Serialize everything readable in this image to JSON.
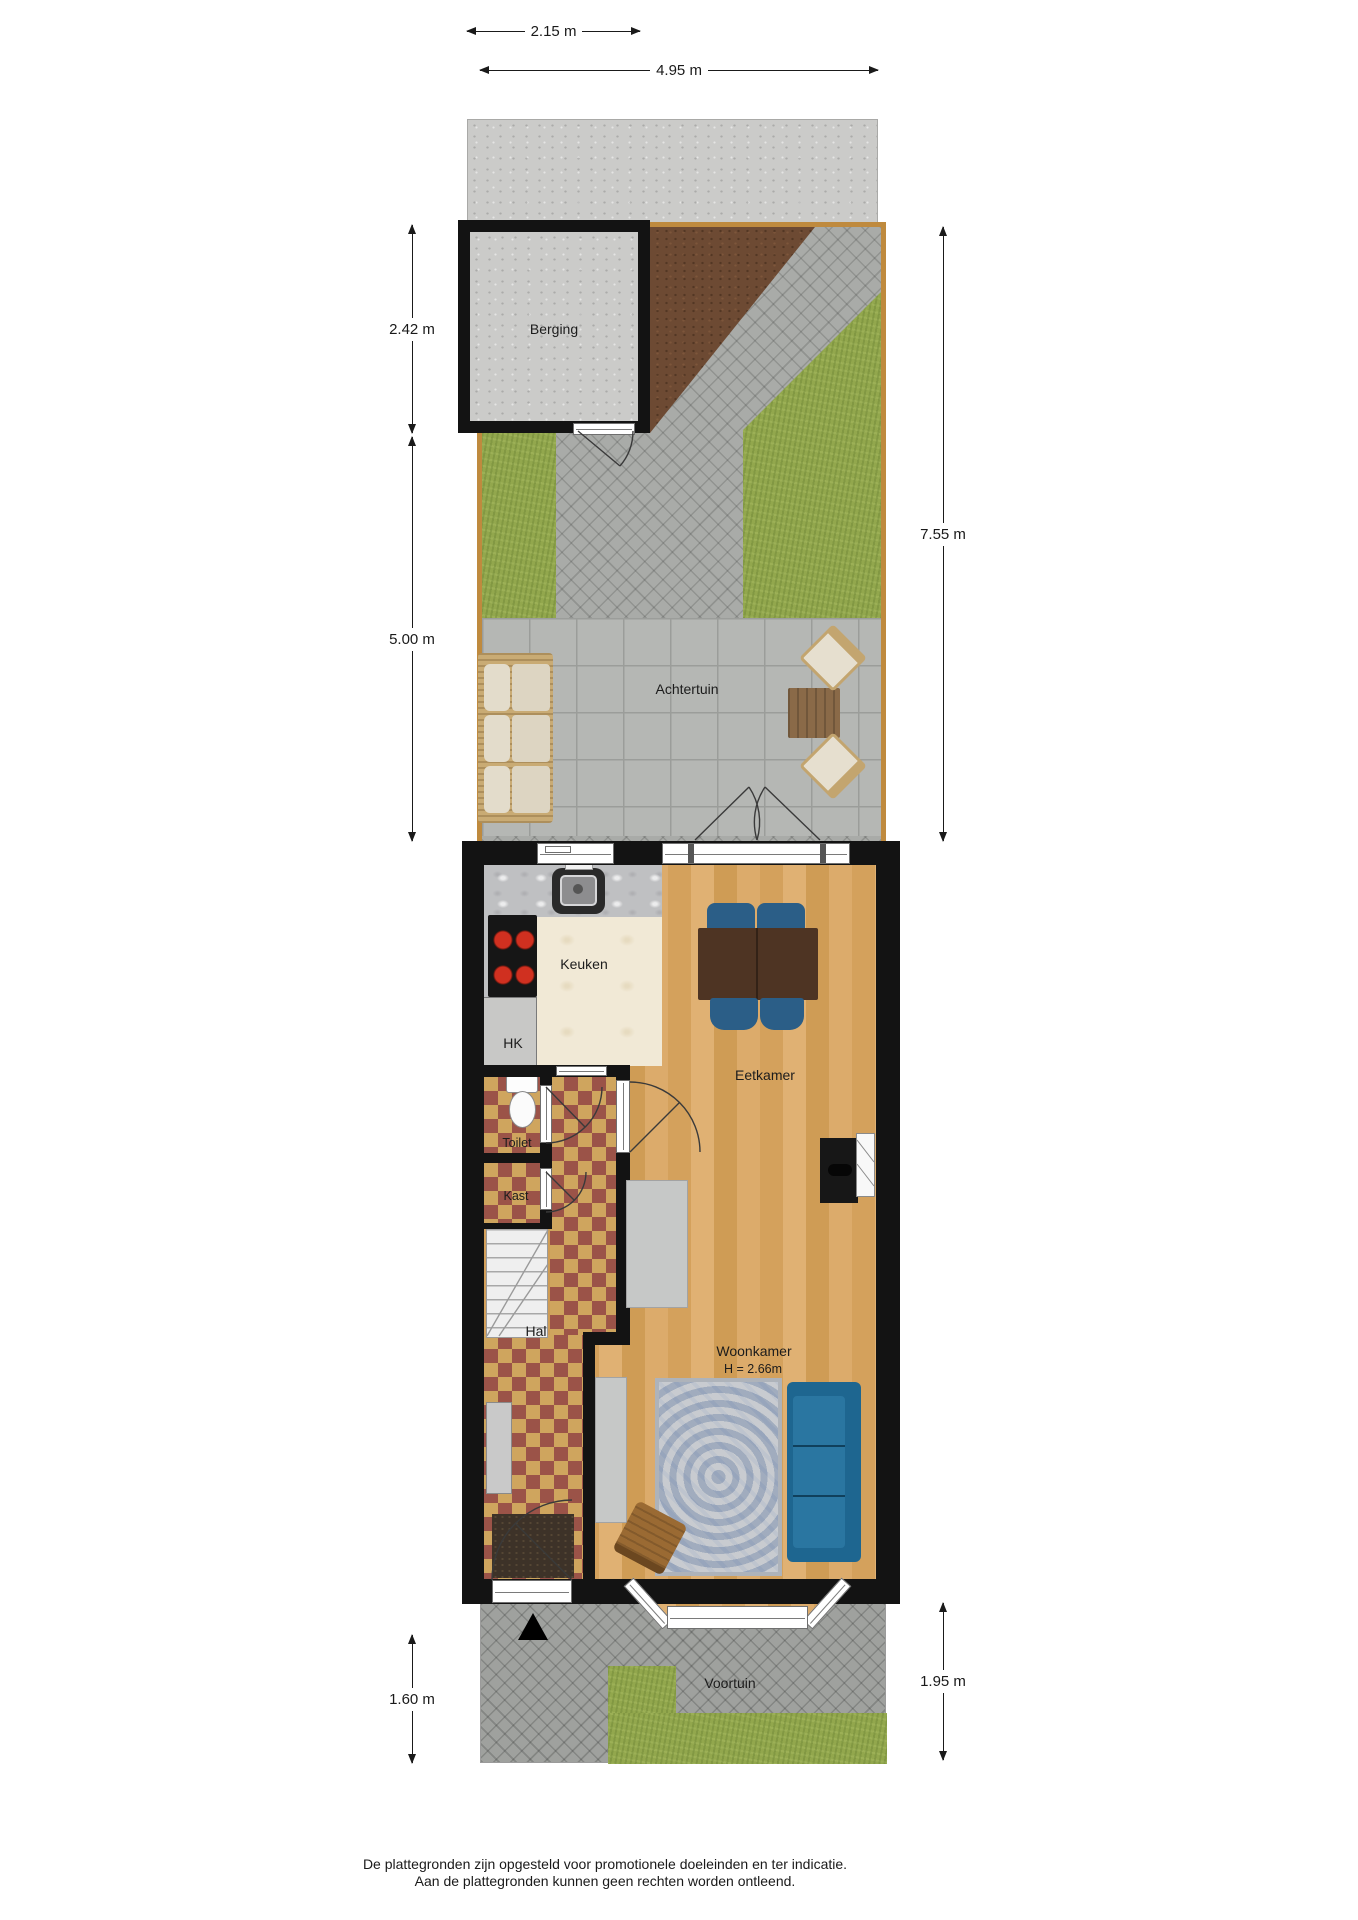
{
  "rooms": {
    "shed": "Berging",
    "back_garden": "Achtertuin",
    "kitchen": "Keuken",
    "utility": "HK",
    "toilet": "Toilet",
    "closet": "Kast",
    "hall": "Hal",
    "dining_room": "Eetkamer",
    "living_room": "Woonkamer",
    "living_room_ceiling_height": "H = 2.66m",
    "front_garden": "Voortuin"
  },
  "dimensions": {
    "shed_width": "2.15 m",
    "garden_width": "4.95 m",
    "shed_depth": "2.42 m",
    "garden_left_depth": "5.00 m",
    "garden_right_depth": "7.55 m",
    "front_garden_left_depth": "1.60 m",
    "front_garden_right_depth": "1.95 m"
  },
  "disclaimer": {
    "line1": "De plattegronden zijn opgesteld voor promotionele doeleinden en ter indicatie.",
    "line2": "Aan de plattegronden kunnen geen rechten worden ontleend."
  },
  "colors": {
    "wall": "#131313",
    "fence": "#bf8a3e",
    "grass": "#92a74d",
    "dirt": "#6d4a33",
    "paving_slabs": "#b5b7b4",
    "brick_path": "#a9aba8",
    "wood_floor": "#d9a967",
    "kitchen_floor": "#f1e9d6",
    "checker_red": "#9b5348",
    "checker_tan": "#cfa55e",
    "sofa_blue": "#1e6690",
    "dining_chair_blue": "#2b5e87",
    "rug_gray": "#bcc0c5"
  }
}
